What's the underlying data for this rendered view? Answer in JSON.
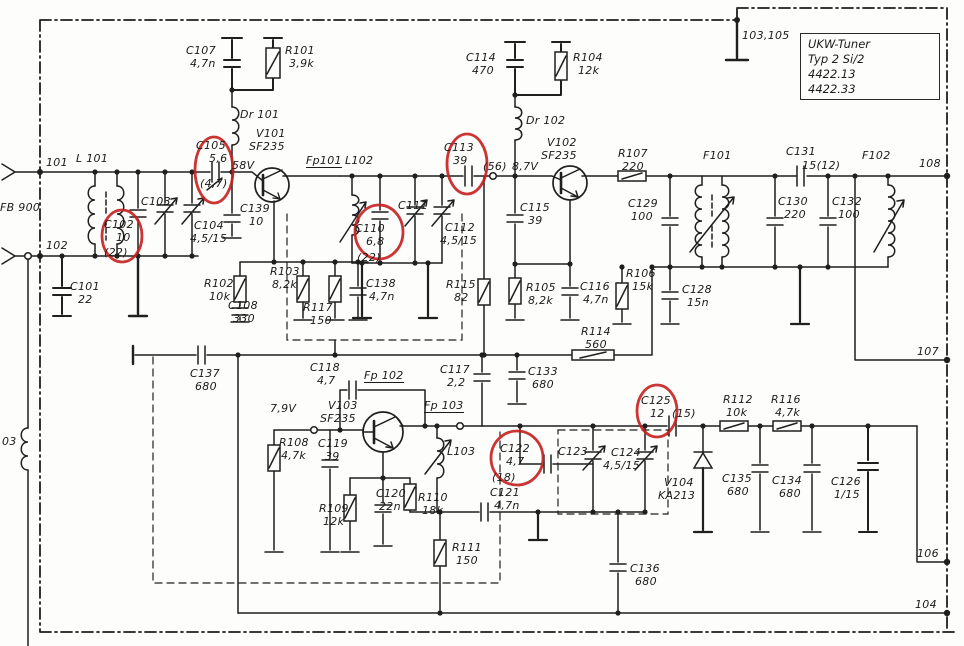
{
  "title_box": {
    "line1": "UKW-Tuner",
    "line2": "Typ 2 Si/2",
    "line3": "4422.13",
    "line4": "4422.33"
  },
  "colors": {
    "ink": "#1f1f1f",
    "highlight": "#c5201f",
    "paper": "#fdfdfc"
  },
  "labels": [
    {
      "t": "C107",
      "x": 186,
      "y": 45
    },
    {
      "t": "4,7n",
      "x": 190,
      "y": 58
    },
    {
      "t": "R101",
      "x": 285,
      "y": 45
    },
    {
      "t": "3,9k",
      "x": 289,
      "y": 58
    },
    {
      "t": "Dr 101",
      "x": 240,
      "y": 109
    },
    {
      "t": "V101",
      "x": 256,
      "y": 128
    },
    {
      "t": "SF235",
      "x": 249,
      "y": 141
    },
    {
      "t": "C105",
      "x": 196,
      "y": 140
    },
    {
      "t": "5,6",
      "x": 209,
      "y": 153
    },
    {
      "t": "(4,7)",
      "x": 200,
      "y": 178
    },
    {
      "t": "58V",
      "x": 232,
      "y": 160
    },
    {
      "t": "Fp101",
      "x": 306,
      "y": 155,
      "u": true
    },
    {
      "t": "L102",
      "x": 345,
      "y": 155
    },
    {
      "t": "101",
      "x": 46,
      "y": 157
    },
    {
      "t": "L 101",
      "x": 76,
      "y": 153
    },
    {
      "t": "FB 900",
      "x": 0,
      "y": 202
    },
    {
      "t": "102",
      "x": 46,
      "y": 240
    },
    {
      "t": "C101",
      "x": 70,
      "y": 281
    },
    {
      "t": "22",
      "x": 78,
      "y": 294
    },
    {
      "t": "C103",
      "x": 141,
      "y": 196
    },
    {
      "t": "C102",
      "x": 104,
      "y": 219
    },
    {
      "t": "10",
      "x": 116,
      "y": 232
    },
    {
      "t": "(22)",
      "x": 104,
      "y": 247
    },
    {
      "t": "C104",
      "x": 194,
      "y": 220
    },
    {
      "t": "4,5/15",
      "x": 190,
      "y": 233
    },
    {
      "t": "C139",
      "x": 240,
      "y": 203
    },
    {
      "t": "10",
      "x": 249,
      "y": 216
    },
    {
      "t": "R102",
      "x": 204,
      "y": 278
    },
    {
      "t": "10k",
      "x": 209,
      "y": 291
    },
    {
      "t": "R103",
      "x": 270,
      "y": 266
    },
    {
      "t": "8,2k",
      "x": 272,
      "y": 279
    },
    {
      "t": "C108",
      "x": 228,
      "y": 300
    },
    {
      "t": "330",
      "x": 233,
      "y": 313
    },
    {
      "t": "R117",
      "x": 303,
      "y": 302
    },
    {
      "t": "150",
      "x": 310,
      "y": 315
    },
    {
      "t": "C138",
      "x": 366,
      "y": 278
    },
    {
      "t": "4,7n",
      "x": 369,
      "y": 291
    },
    {
      "t": "C110",
      "x": 355,
      "y": 223
    },
    {
      "t": "6,8",
      "x": 366,
      "y": 236
    },
    {
      "t": "(22)",
      "x": 357,
      "y": 252
    },
    {
      "t": "C111",
      "x": 398,
      "y": 200
    },
    {
      "t": "C112",
      "x": 445,
      "y": 222
    },
    {
      "t": "4,5/15",
      "x": 440,
      "y": 235
    },
    {
      "t": "C113",
      "x": 444,
      "y": 142
    },
    {
      "t": "39",
      "x": 453,
      "y": 155
    },
    {
      "t": "(56)",
      "x": 483,
      "y": 161
    },
    {
      "t": "8,7V",
      "x": 512,
      "y": 161
    },
    {
      "t": "Dr 102",
      "x": 526,
      "y": 115
    },
    {
      "t": "C114",
      "x": 466,
      "y": 52
    },
    {
      "t": "470",
      "x": 472,
      "y": 65
    },
    {
      "t": "R104",
      "x": 573,
      "y": 52
    },
    {
      "t": "12k",
      "x": 578,
      "y": 65
    },
    {
      "t": "V102",
      "x": 547,
      "y": 137
    },
    {
      "t": "SF235",
      "x": 541,
      "y": 150
    },
    {
      "t": "C115",
      "x": 520,
      "y": 202
    },
    {
      "t": "39",
      "x": 528,
      "y": 215
    },
    {
      "t": "R105",
      "x": 526,
      "y": 282
    },
    {
      "t": "8,2k",
      "x": 528,
      "y": 295
    },
    {
      "t": "C116",
      "x": 580,
      "y": 281
    },
    {
      "t": "4,7n",
      "x": 583,
      "y": 294
    },
    {
      "t": "R115",
      "x": 446,
      "y": 279
    },
    {
      "t": "82",
      "x": 454,
      "y": 292
    },
    {
      "t": "R114",
      "x": 581,
      "y": 326
    },
    {
      "t": "560",
      "x": 585,
      "y": 339
    },
    {
      "t": "R106",
      "x": 626,
      "y": 268
    },
    {
      "t": "15k",
      "x": 632,
      "y": 281
    },
    {
      "t": "R107",
      "x": 618,
      "y": 148
    },
    {
      "t": "220",
      "x": 622,
      "y": 161
    },
    {
      "t": "C129",
      "x": 628,
      "y": 198
    },
    {
      "t": "100",
      "x": 631,
      "y": 211
    },
    {
      "t": "C128",
      "x": 682,
      "y": 284
    },
    {
      "t": "15n",
      "x": 687,
      "y": 297
    },
    {
      "t": "F101",
      "x": 703,
      "y": 150
    },
    {
      "t": "C130",
      "x": 778,
      "y": 196
    },
    {
      "t": "220",
      "x": 784,
      "y": 209
    },
    {
      "t": "C131",
      "x": 786,
      "y": 146
    },
    {
      "t": "15(12)",
      "x": 802,
      "y": 160
    },
    {
      "t": "C132",
      "x": 832,
      "y": 196
    },
    {
      "t": "100",
      "x": 838,
      "y": 209
    },
    {
      "t": "F102",
      "x": 862,
      "y": 150
    },
    {
      "t": "108",
      "x": 919,
      "y": 158
    },
    {
      "t": "107",
      "x": 917,
      "y": 346
    },
    {
      "t": "106",
      "x": 917,
      "y": 548
    },
    {
      "t": "104",
      "x": 915,
      "y": 599
    },
    {
      "t": "103,105",
      "x": 742,
      "y": 30
    },
    {
      "t": "C137",
      "x": 190,
      "y": 368
    },
    {
      "t": "680",
      "x": 195,
      "y": 381
    },
    {
      "t": "C117",
      "x": 440,
      "y": 364
    },
    {
      "t": "2,2",
      "x": 447,
      "y": 377
    },
    {
      "t": "C133",
      "x": 528,
      "y": 366
    },
    {
      "t": "680",
      "x": 532,
      "y": 379
    },
    {
      "t": "C118",
      "x": 310,
      "y": 362
    },
    {
      "t": "4,7",
      "x": 317,
      "y": 375
    },
    {
      "t": "Fp 102",
      "x": 364,
      "y": 370,
      "u": true
    },
    {
      "t": "V103",
      "x": 328,
      "y": 400
    },
    {
      "t": "SF235",
      "x": 320,
      "y": 413
    },
    {
      "t": "Fp 103",
      "x": 424,
      "y": 400,
      "u": true
    },
    {
      "t": "7,9V",
      "x": 270,
      "y": 403
    },
    {
      "t": "R108",
      "x": 279,
      "y": 437
    },
    {
      "t": "4,7k",
      "x": 281,
      "y": 450
    },
    {
      "t": "C119",
      "x": 318,
      "y": 438
    },
    {
      "t": "39",
      "x": 325,
      "y": 451
    },
    {
      "t": "R109",
      "x": 319,
      "y": 503
    },
    {
      "t": "12k",
      "x": 323,
      "y": 516
    },
    {
      "t": "C120",
      "x": 376,
      "y": 488
    },
    {
      "t": "22n",
      "x": 379,
      "y": 501
    },
    {
      "t": "R110",
      "x": 418,
      "y": 492
    },
    {
      "t": "18k",
      "x": 422,
      "y": 505
    },
    {
      "t": "L103",
      "x": 447,
      "y": 446
    },
    {
      "t": "C122",
      "x": 500,
      "y": 443
    },
    {
      "t": "4,7",
      "x": 506,
      "y": 456
    },
    {
      "t": "(18)",
      "x": 492,
      "y": 472
    },
    {
      "t": "C121",
      "x": 490,
      "y": 487
    },
    {
      "t": "4,7n",
      "x": 494,
      "y": 500
    },
    {
      "t": "R111",
      "x": 452,
      "y": 542
    },
    {
      "t": "150",
      "x": 456,
      "y": 555
    },
    {
      "t": "C123",
      "x": 558,
      "y": 446
    },
    {
      "t": "C124",
      "x": 611,
      "y": 447
    },
    {
      "t": "4,5/15",
      "x": 603,
      "y": 460
    },
    {
      "t": "C125",
      "x": 641,
      "y": 395
    },
    {
      "t": "12",
      "x": 650,
      "y": 408
    },
    {
      "t": "(15)",
      "x": 672,
      "y": 408
    },
    {
      "t": "V104",
      "x": 664,
      "y": 477
    },
    {
      "t": "KA213",
      "x": 658,
      "y": 490
    },
    {
      "t": "R112",
      "x": 723,
      "y": 394
    },
    {
      "t": "10k",
      "x": 726,
      "y": 407
    },
    {
      "t": "C135",
      "x": 722,
      "y": 473
    },
    {
      "t": "680",
      "x": 727,
      "y": 486
    },
    {
      "t": "R116",
      "x": 771,
      "y": 394
    },
    {
      "t": "4,7k",
      "x": 775,
      "y": 407
    },
    {
      "t": "C134",
      "x": 772,
      "y": 475
    },
    {
      "t": "680",
      "x": 779,
      "y": 488
    },
    {
      "t": "C126",
      "x": 831,
      "y": 476
    },
    {
      "t": "1/15",
      "x": 834,
      "y": 489
    },
    {
      "t": "C136",
      "x": 630,
      "y": 563
    },
    {
      "t": "680",
      "x": 635,
      "y": 576
    },
    {
      "t": "03",
      "x": 2,
      "y": 436
    }
  ],
  "circled": [
    {
      "cx": 214,
      "cy": 170,
      "rx": 19,
      "ry": 33
    },
    {
      "cx": 122,
      "cy": 236,
      "rx": 20,
      "ry": 26
    },
    {
      "cx": 379,
      "cy": 232,
      "rx": 24,
      "ry": 27
    },
    {
      "cx": 467,
      "cy": 164,
      "rx": 20,
      "ry": 30
    },
    {
      "cx": 517,
      "cy": 458,
      "rx": 26,
      "ry": 27
    },
    {
      "cx": 657,
      "cy": 411,
      "rx": 20,
      "ry": 26
    }
  ]
}
